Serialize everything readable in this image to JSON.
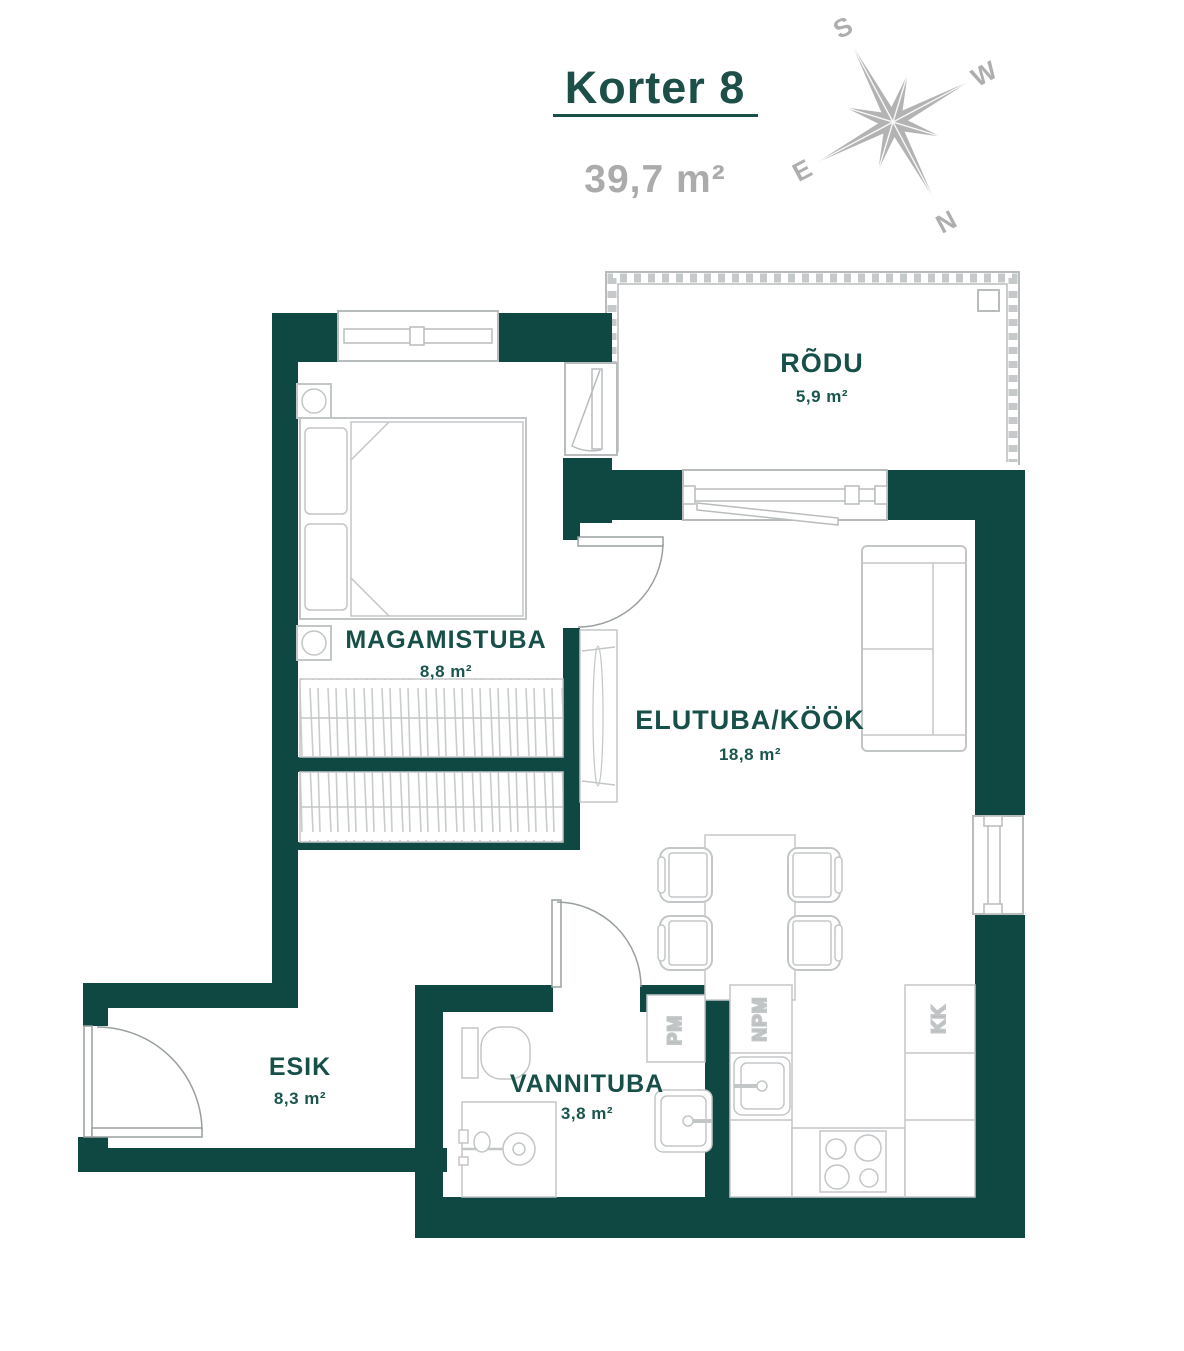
{
  "header": {
    "title": "Korter 8",
    "total_area": "39,7 m²"
  },
  "compass": {
    "n": "N",
    "s": "S",
    "e": "E",
    "w": "W"
  },
  "rooms": {
    "rodu": {
      "name": "RÕDU",
      "area": "5,9 m²"
    },
    "magamistuba": {
      "name": "MAGAMISTUBA",
      "area": "8,8 m²"
    },
    "elutuba": {
      "name": "ELUTUBA/KÖÖK",
      "area": "18,8 m²"
    },
    "esik": {
      "name": "ESIK",
      "area": "8,3 m²"
    },
    "vannituba": {
      "name": "VANNITUBA",
      "area": "3,8 m²"
    }
  },
  "appliances": {
    "pm": "PM",
    "npm": "NPM",
    "kk": "KK"
  },
  "colors": {
    "wall": "#0F4842",
    "room_label": "#175049",
    "title": "#1B4F48",
    "total_area_gray": "#ABABAB",
    "furniture_gray": "#C3C6C7",
    "door_gray": "#999FA0",
    "compass_gray": "#B2B2B2"
  }
}
